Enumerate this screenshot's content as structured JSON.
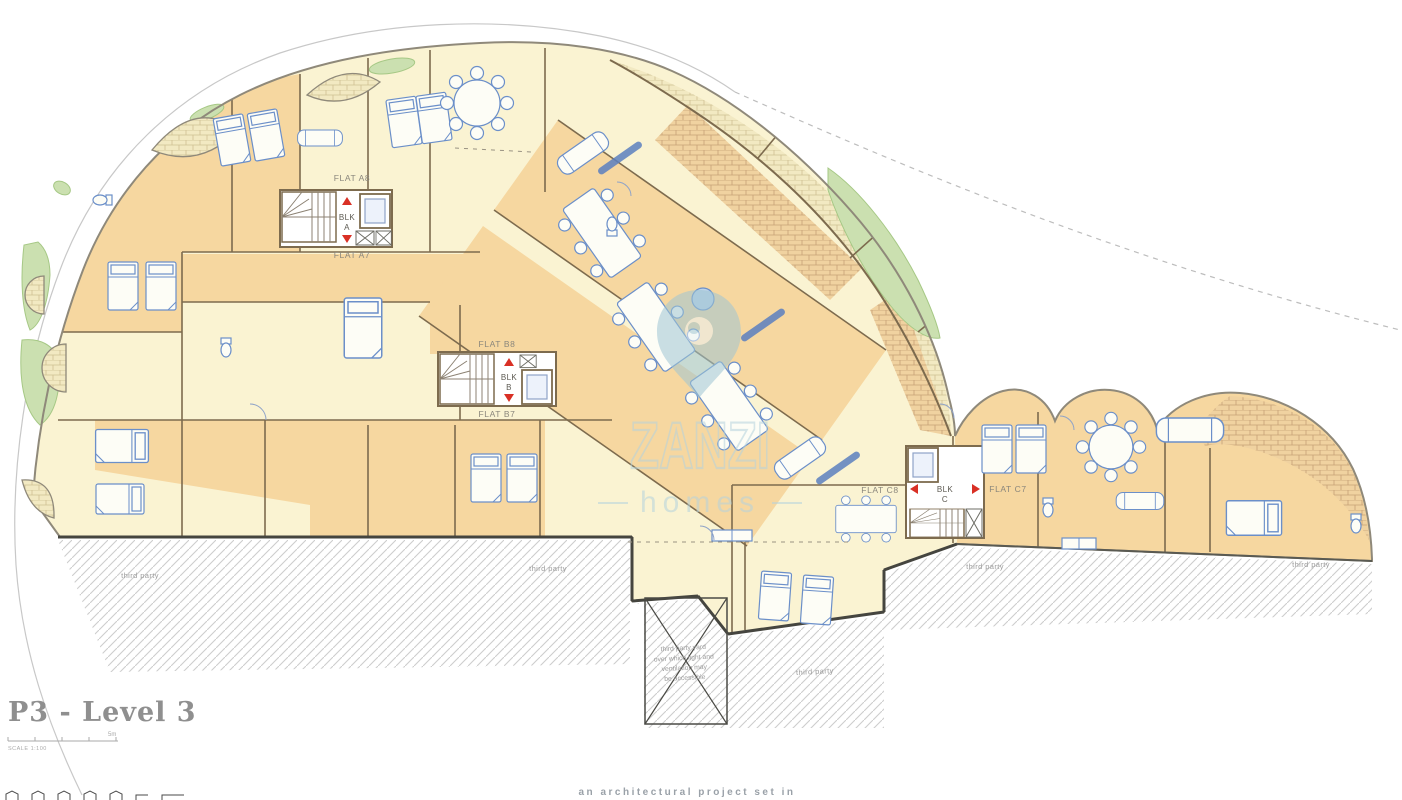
{
  "plan": {
    "title": "P3 - Level 3",
    "scale_label": "SCALE 1:100",
    "scale_end_label": "5m"
  },
  "flats": {
    "a8": "FLAT A8",
    "a7": "FLAT A7",
    "b8": "FLAT B8",
    "b7": "FLAT B7",
    "c8": "FLAT C8",
    "c7": "FLAT C7"
  },
  "cores": {
    "blk": "BLK",
    "a": "A",
    "b": "B",
    "c": "C"
  },
  "annotations": {
    "third_party": "third party",
    "yard_l1": "third party yard",
    "yard_l2": "over which light and",
    "yard_l3": "ventilation may",
    "yard_l4": "be accessible"
  },
  "watermark": {
    "brand": "ZANZI",
    "sub": "homes"
  },
  "footer": {
    "tagline": "an architectural project set in"
  },
  "colors": {
    "room_cream": "#FAF3D2",
    "room_orange": "#F6D7A0",
    "wall_brown": "#7D6B4E",
    "wall_dark": "#45453f",
    "furniture_blue": "#6B8FC9",
    "planter_green": "#CBE0B0",
    "core_marker_red": "#D93025",
    "hatch_gray": "#CDCDCD",
    "label_gray": "#8a867c",
    "watermark_blue": "#b5d3dd"
  }
}
